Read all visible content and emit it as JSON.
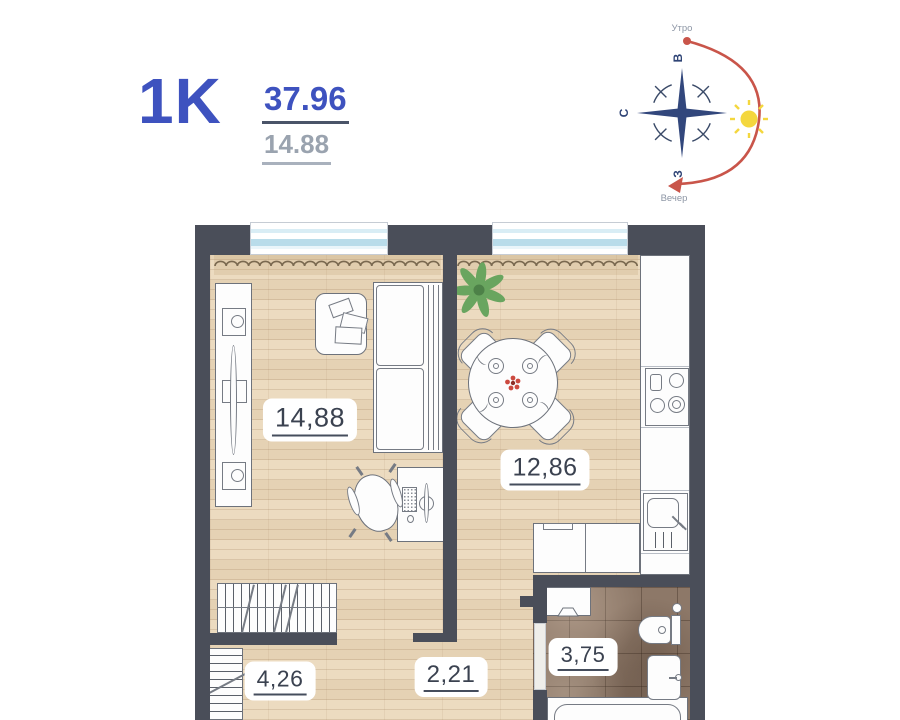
{
  "header": {
    "plan_type": "1K",
    "total_area": "37.96",
    "living_area": "14.88"
  },
  "compass": {
    "morning_label": "Утро",
    "evening_label": "Вечер",
    "dir_east": "В",
    "dir_north": "С",
    "dir_west": "З"
  },
  "rooms": {
    "living": {
      "area": "14,88"
    },
    "kitchen": {
      "area": "12,86"
    },
    "bathroom": {
      "area": "3,75"
    },
    "hallway": {
      "area": "4,26"
    },
    "corridor": {
      "area": "2,21"
    }
  },
  "colors": {
    "accent_blue": "#3e52bf",
    "muted_gray": "#9aa3af",
    "wall": "#4a4e59",
    "floor_wood": "#ebd8bb",
    "floor_tile": "#8d7868",
    "daylight_arc_red": "#c9554a",
    "sun_yellow": "#f4d73e",
    "compass_navy": "#32477c",
    "label_text": "#3b4250"
  }
}
